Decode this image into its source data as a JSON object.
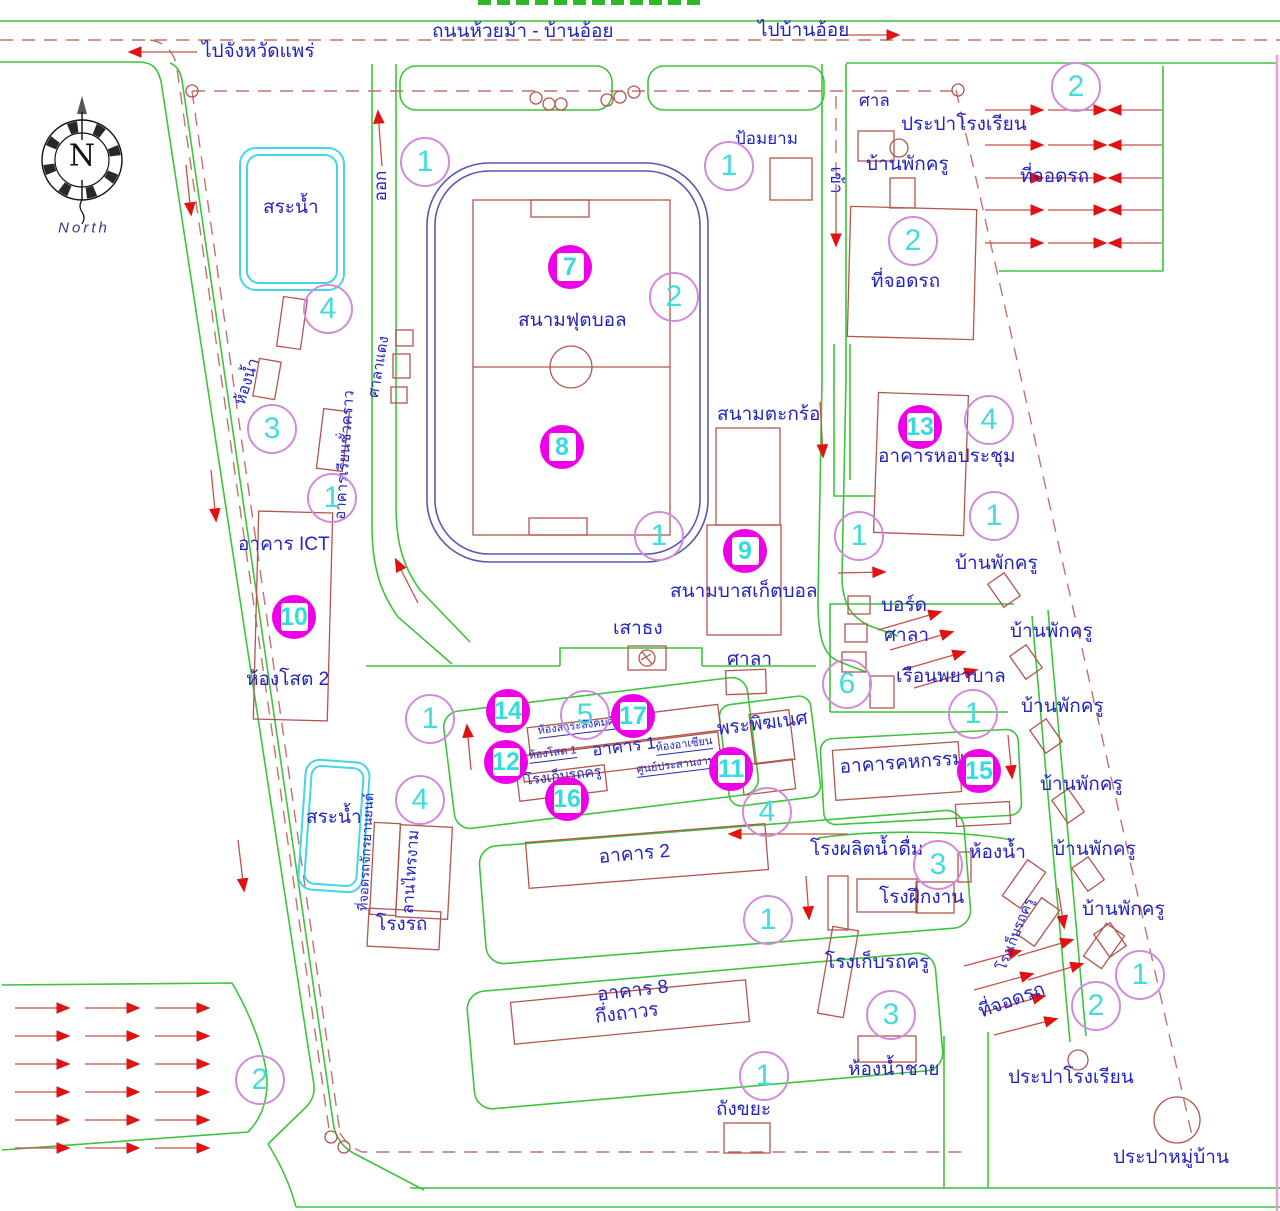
{
  "map_title_note": "",
  "compass": {
    "letter": "N",
    "caption": "North"
  },
  "labels": [
    {
      "id": "road-huai-ma",
      "text": "ถนนห้วยม้า - บ้านอ้อย",
      "x": 432,
      "y": 22,
      "s": 19
    },
    {
      "id": "to-ban-oi",
      "text": "ไปบ้านอ้อย",
      "x": 758,
      "y": 21,
      "s": 19
    },
    {
      "id": "to-phrae",
      "text": "ไปจังหวัดแพร่",
      "x": 202,
      "y": 42,
      "s": 19
    },
    {
      "id": "pond-top",
      "text": "สระน้ำ",
      "x": 263,
      "y": 198,
      "s": 19
    },
    {
      "id": "guard-post",
      "text": "ป้อมยาม",
      "x": 735,
      "y": 130,
      "s": 17
    },
    {
      "id": "shrine",
      "text": "ศาล",
      "x": 859,
      "y": 92,
      "s": 17
    },
    {
      "id": "school-waterworks-top",
      "text": "ประปาโรงเรียน",
      "x": 901,
      "y": 115,
      "s": 19
    },
    {
      "id": "teacher-house-top",
      "text": "บ้านพักครู",
      "x": 866,
      "y": 155,
      "s": 19
    },
    {
      "id": "parking-top-right",
      "text": "ที่จอดรถ",
      "x": 1020,
      "y": 167,
      "s": 19
    },
    {
      "id": "parking-block",
      "text": "ที่จอดรถ",
      "x": 871,
      "y": 272,
      "s": 19
    },
    {
      "id": "football-field",
      "text": "สนามฟุตบอล",
      "x": 518,
      "y": 311,
      "s": 19
    },
    {
      "id": "takraw-court",
      "text": "สนามตะกร้อ",
      "x": 717,
      "y": 405,
      "s": 19
    },
    {
      "id": "basketball-court",
      "text": "สนามบาสเก็ตบอล",
      "x": 670,
      "y": 582,
      "s": 19
    },
    {
      "id": "assembly-hall",
      "text": "อาคารหอประชุม",
      "x": 878,
      "y": 447,
      "s": 19
    },
    {
      "id": "teacher-house-1",
      "text": "บ้านพักครู",
      "x": 955,
      "y": 554,
      "s": 19
    },
    {
      "id": "ict-building",
      "text": "อาคาร ICT",
      "x": 238,
      "y": 535,
      "s": 19
    },
    {
      "id": "av-room-2",
      "text": "ห้องโสต 2",
      "x": 246,
      "y": 670,
      "s": 19
    },
    {
      "id": "flagpole",
      "text": "เสาธง",
      "x": 613,
      "y": 619,
      "s": 19
    },
    {
      "id": "pavilion-mid",
      "text": "ศาลา",
      "x": 727,
      "y": 650,
      "s": 19
    },
    {
      "id": "board",
      "text": "บอร์ด",
      "x": 881,
      "y": 596,
      "s": 19
    },
    {
      "id": "pavilion-right",
      "text": "ศาลา",
      "x": 884,
      "y": 626,
      "s": 19
    },
    {
      "id": "infirmary",
      "text": "เรือนพยาบาล",
      "x": 896,
      "y": 667,
      "s": 19
    },
    {
      "id": "teacher-house-2",
      "text": "บ้านพักครู",
      "x": 1010,
      "y": 622,
      "s": 19
    },
    {
      "id": "teacher-house-3",
      "text": "บ้านพักครู",
      "x": 1021,
      "y": 697,
      "s": 19
    },
    {
      "id": "ganesha",
      "text": "พระพิฆเนศ",
      "x": 716,
      "y": 720,
      "s": 19,
      "r": -7
    },
    {
      "id": "social-studies-room",
      "text": "ห้องสาระสังคมศึกษา",
      "x": 537,
      "y": 726,
      "s": 11,
      "r": -7,
      "u": 1
    },
    {
      "id": "asean-room",
      "text": "ห้องอาเซียน",
      "x": 655,
      "y": 743,
      "s": 11,
      "r": -7,
      "u": 1
    },
    {
      "id": "building-1",
      "text": "อาคาร 1",
      "x": 591,
      "y": 742,
      "s": 17,
      "r": -7
    },
    {
      "id": "av-room-1",
      "text": "ห้องโสต 1",
      "x": 528,
      "y": 751,
      "s": 11,
      "r": -7,
      "u": 1
    },
    {
      "id": "coordination-center",
      "text": "ศูนย์ประสานงาน",
      "x": 636,
      "y": 765,
      "s": 11,
      "r": -7,
      "u": 1
    },
    {
      "id": "teacher-garage-1",
      "text": "โรงเก็บรถครู",
      "x": 524,
      "y": 773,
      "s": 14,
      "r": -7
    },
    {
      "id": "home-econ-building",
      "text": "อาคารคหกรรม",
      "x": 839,
      "y": 758,
      "s": 19,
      "r": -4
    },
    {
      "id": "teacher-house-4",
      "text": "บ้านพักครู",
      "x": 1040,
      "y": 775,
      "s": 19
    },
    {
      "id": "water-plant",
      "text": "โรงผลิตน้ำดื่ม",
      "x": 810,
      "y": 840,
      "s": 19
    },
    {
      "id": "toilet-right",
      "text": "ห้องน้ำ",
      "x": 969,
      "y": 843,
      "s": 19
    },
    {
      "id": "teacher-house-5",
      "text": "บ้านพักครู",
      "x": 1053,
      "y": 840,
      "s": 19
    },
    {
      "id": "workshop",
      "text": "โรงฝึกงาน",
      "x": 879,
      "y": 888,
      "s": 19
    },
    {
      "id": "pond-lower",
      "text": "สระน้ำ",
      "x": 306,
      "y": 808,
      "s": 19
    },
    {
      "id": "carport",
      "text": "โรงรถ",
      "x": 376,
      "y": 915,
      "s": 19
    },
    {
      "id": "building-2",
      "text": "อาคาร 2",
      "x": 598,
      "y": 848,
      "s": 19,
      "r": -5
    },
    {
      "id": "teacher-garage-2",
      "text": "โรงเก็บรถครู",
      "x": 825,
      "y": 953,
      "s": 19
    },
    {
      "id": "mens-toilet",
      "text": "ห้องน้ำชาย",
      "x": 848,
      "y": 1060,
      "s": 19
    },
    {
      "id": "parking-bottom-right",
      "text": "ที่จอดรถ",
      "cx": 1012,
      "cy": 1001,
      "s": 19,
      "r": -20
    },
    {
      "id": "school-waterworks-bottom",
      "text": "ประปาโรงเรียน",
      "x": 1008,
      "y": 1068,
      "s": 19
    },
    {
      "id": "teacher-house-6",
      "text": "บ้านพักครู",
      "x": 1082,
      "y": 900,
      "s": 19
    },
    {
      "id": "building-8",
      "text": "อาคาร 8",
      "x": 596,
      "y": 986,
      "s": 19,
      "r": -7
    },
    {
      "id": "building-8-sub",
      "text": "กึ่งถาวร",
      "x": 594,
      "y": 1008,
      "s": 19,
      "r": -7
    },
    {
      "id": "trash-bin",
      "text": "ถังขยะ",
      "x": 716,
      "y": 1100,
      "s": 19
    },
    {
      "id": "village-waterworks",
      "text": "ประปาหมู่บ้าน",
      "x": 1113,
      "y": 1148,
      "s": 19
    },
    {
      "id": "exit",
      "text": "ออก",
      "cx": 381,
      "cy": 186,
      "s": 17,
      "r": -90
    },
    {
      "id": "enter",
      "text": "เข้า",
      "cx": 836,
      "cy": 180,
      "s": 17,
      "r": 90
    },
    {
      "id": "toilet-left",
      "text": "ห้องน้ำ",
      "cx": 248,
      "cy": 382,
      "s": 16,
      "r": -72
    },
    {
      "id": "temp-classroom",
      "text": "อาคารเรียนชั่วคราว",
      "cx": 345,
      "cy": 455,
      "s": 15,
      "r": -86
    },
    {
      "id": "red-pavilion",
      "text": "ศาลาแดง",
      "cx": 379,
      "cy": 367,
      "s": 15,
      "r": -80
    },
    {
      "id": "motorcycle-parking",
      "text": "ที่จอดรถจักรยานยนต์",
      "cx": 366,
      "cy": 852,
      "s": 13,
      "r": -87
    },
    {
      "id": "lan-sai-ngam",
      "text": "ลานไทรงาม",
      "cx": 412,
      "cy": 872,
      "s": 16,
      "r": -86
    },
    {
      "id": "teacher-garage-3",
      "text": "โรงเก็บรถครู",
      "cx": 1015,
      "cy": 934,
      "s": 14,
      "r": -68
    }
  ],
  "filled_markers": [
    {
      "n": "7",
      "cx": 570,
      "cy": 267
    },
    {
      "n": "8",
      "cx": 562,
      "cy": 447
    },
    {
      "n": "9",
      "cx": 745,
      "cy": 551
    },
    {
      "n": "10",
      "cx": 294,
      "cy": 617
    },
    {
      "n": "13",
      "cx": 920,
      "cy": 427
    },
    {
      "n": "14",
      "cx": 508,
      "cy": 711
    },
    {
      "n": "17",
      "cx": 633,
      "cy": 716
    },
    {
      "n": "12",
      "cx": 506,
      "cy": 762
    },
    {
      "n": "11",
      "cx": 731,
      "cy": 769
    },
    {
      "n": "16",
      "cx": 567,
      "cy": 799
    },
    {
      "n": "15",
      "cx": 979,
      "cy": 771
    }
  ],
  "outline_markers": [
    {
      "n": "1",
      "cx": 425,
      "cy": 162
    },
    {
      "n": "1",
      "cx": 729,
      "cy": 166
    },
    {
      "n": "2",
      "cx": 1076,
      "cy": 87
    },
    {
      "n": "2",
      "cx": 913,
      "cy": 241
    },
    {
      "n": "2",
      "cx": 674,
      "cy": 297
    },
    {
      "n": "4",
      "cx": 328,
      "cy": 309
    },
    {
      "n": "3",
      "cx": 272,
      "cy": 429
    },
    {
      "n": "1",
      "cx": 332,
      "cy": 498
    },
    {
      "n": "1",
      "cx": 659,
      "cy": 536
    },
    {
      "n": "4",
      "cx": 989,
      "cy": 420
    },
    {
      "n": "1",
      "cx": 994,
      "cy": 516
    },
    {
      "n": "1",
      "cx": 859,
      "cy": 536
    },
    {
      "n": "6",
      "cx": 847,
      "cy": 684
    },
    {
      "n": "1",
      "cx": 973,
      "cy": 714
    },
    {
      "n": "1",
      "cx": 430,
      "cy": 719
    },
    {
      "n": "5",
      "cx": 585,
      "cy": 715
    },
    {
      "n": "4",
      "cx": 767,
      "cy": 812
    },
    {
      "n": "4",
      "cx": 420,
      "cy": 800
    },
    {
      "n": "1",
      "cx": 768,
      "cy": 920
    },
    {
      "n": "3",
      "cx": 938,
      "cy": 865
    },
    {
      "n": "1",
      "cx": 764,
      "cy": 1076
    },
    {
      "n": "3",
      "cx": 891,
      "cy": 1015
    },
    {
      "n": "2",
      "cx": 1096,
      "cy": 1006
    },
    {
      "n": "1",
      "cx": 1140,
      "cy": 975
    },
    {
      "n": "2",
      "cx": 260,
      "cy": 1080
    }
  ],
  "colors": {
    "road_green": "#3cc43c",
    "route_red": "#c4726a",
    "arrow_red": "#e01212",
    "building_brown": "#b3564e",
    "label_blue": "#2222c2",
    "pond_cyan": "#45d5e8",
    "track_blue": "#5959ac",
    "marker_magenta": "#ee00e6",
    "marker_cyan": "#41dcdc",
    "marker_outline_violet": "#d08cda",
    "edge_pink": "#f49ad2"
  }
}
